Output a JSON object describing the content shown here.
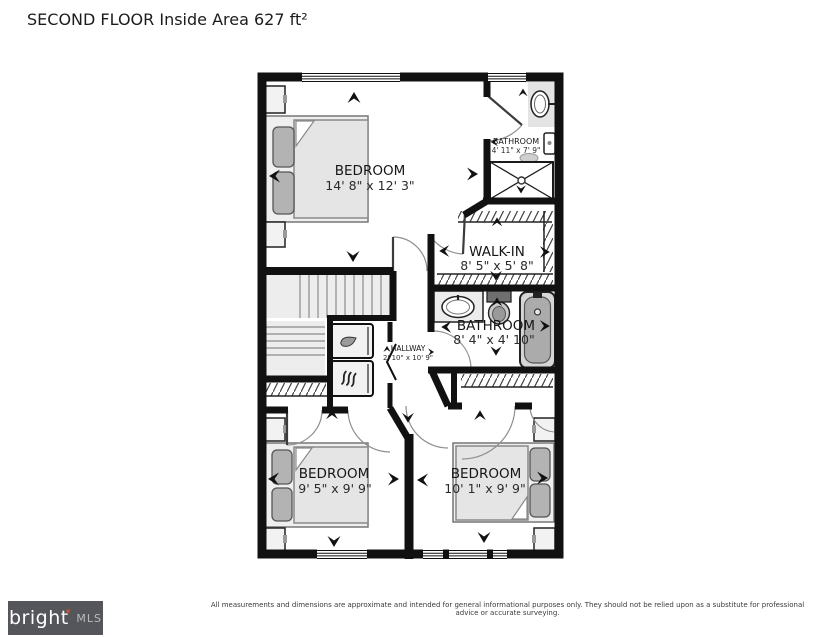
{
  "title": "SECOND FLOOR Inside Area 627 ft²",
  "floor_plan": {
    "rooms": [
      {
        "name": "BEDROOM",
        "dimensions": "14' 8\" x 12' 3\""
      },
      {
        "name": "BATHROOM",
        "dimensions": "4' 11\" x 7' 9\""
      },
      {
        "name": "WALK-IN",
        "dimensions": "8' 5\" x 5' 8\""
      },
      {
        "name": "BATHROOM",
        "dimensions": "8' 4\" x 4' 10\""
      },
      {
        "name": "HALLWAY",
        "dimensions": "2' 10\" x 10' 9\""
      },
      {
        "name": "BEDROOM",
        "dimensions": "9' 5\" x 9' 9\""
      },
      {
        "name": "BEDROOM",
        "dimensions": "10' 1\" x 9' 9\""
      }
    ]
  },
  "footer": {
    "disclaimer": "All measurements and dimensions are approximate and intended for general informational purposes only. They should not be relied upon as a substitute for professional advice or accurate surveying."
  },
  "logo": {
    "brand": "bright",
    "suffix": "MLS",
    "star": "✶"
  },
  "colors": {
    "wall": "#111111",
    "logo_bg": "#54565b",
    "star": "#d9572b",
    "stairs": "#ededed"
  }
}
